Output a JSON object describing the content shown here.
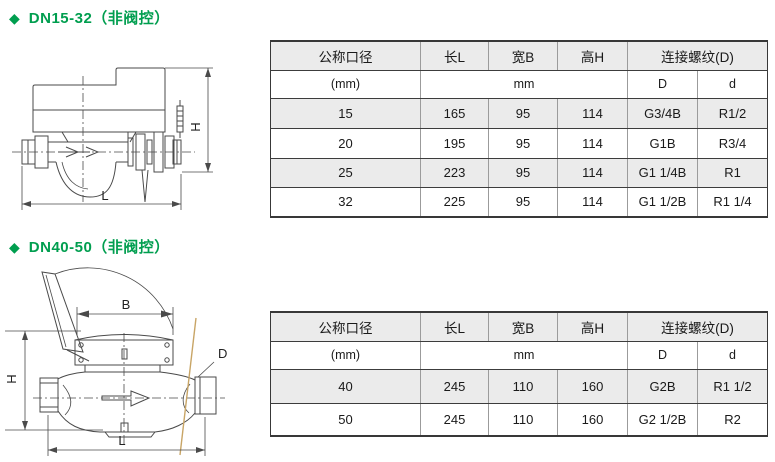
{
  "colors": {
    "accent_green": "#009e4f",
    "row_shade": "#ebebeb",
    "border_dark": "#383838",
    "border_light": "#9b9b9b",
    "drawing_stroke": "#4a4a4a",
    "probe_line_tan": "#c8a566"
  },
  "sections": [
    {
      "bullet": "◆",
      "title": "DN15-32（非阀控）",
      "drawing": {
        "dim_height": "H",
        "dim_length": "L"
      },
      "table": {
        "headers": [
          "公称口径",
          "长L",
          "宽B",
          "高H",
          "连接螺纹(D)"
        ],
        "units": [
          "(mm)",
          "mm",
          "D",
          "d"
        ],
        "rows": [
          [
            "15",
            "165",
            "95",
            "114",
            "G3/4B",
            "R1/2"
          ],
          [
            "20",
            "195",
            "95",
            "114",
            "G1B",
            "R3/4"
          ],
          [
            "25",
            "223",
            "95",
            "114",
            "G1 1/4B",
            "R1"
          ],
          [
            "32",
            "225",
            "95",
            "114",
            "G1 1/2B",
            "R1 1/4"
          ]
        ]
      }
    },
    {
      "bullet": "◆",
      "title": "DN40-50（非阀控）",
      "drawing": {
        "dim_width": "B",
        "dim_height": "H",
        "dim_length": "L",
        "dim_thread": "D"
      },
      "table": {
        "headers": [
          "公称口径",
          "长L",
          "宽B",
          "高H",
          "连接螺纹(D)"
        ],
        "units": [
          "(mm)",
          "mm",
          "D",
          "d"
        ],
        "rows": [
          [
            "40",
            "245",
            "110",
            "160",
            "G2B",
            "R1 1/2"
          ],
          [
            "50",
            "245",
            "110",
            "160",
            "G2 1/2B",
            "R2"
          ]
        ]
      }
    }
  ]
}
